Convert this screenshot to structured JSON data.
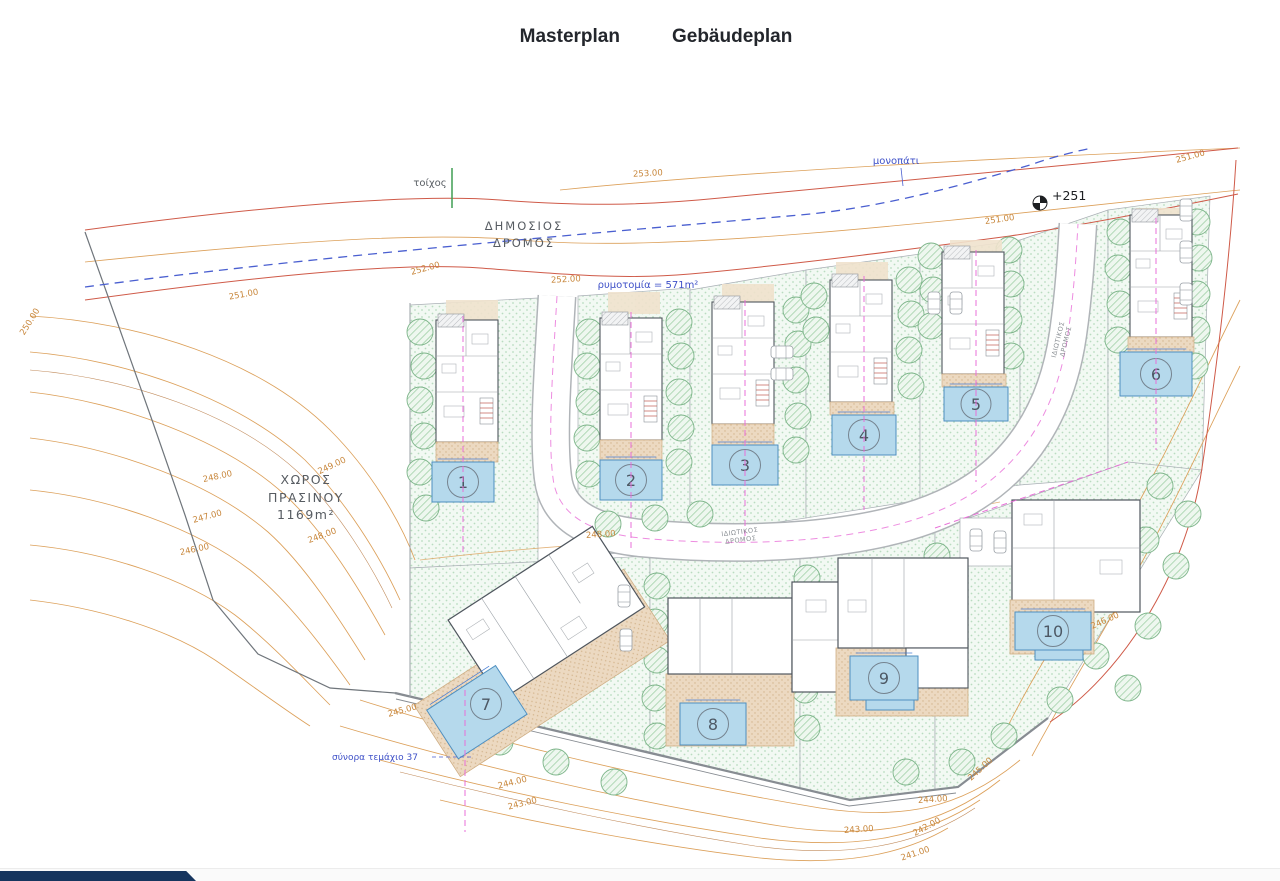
{
  "tabs": [
    {
      "label": "Masterplan",
      "active": true
    },
    {
      "label": "Gebäudeplan",
      "active": false
    }
  ],
  "plan": {
    "labels": {
      "wall": "τοίχος",
      "public_road_1": "ΔΗΜΟΣΙΟΣ",
      "public_road_2": "ΔΡΟΜΟΣ",
      "rymotomia": "ρυμοτομία = 571m²",
      "footpath": "μονοπάτι",
      "datum": "+251",
      "green_1": "ΧΩΡΟΣ",
      "green_2": "ΠΡΑΣΙΝΟΥ",
      "green_area": "1169m²",
      "private_road_l1": "ΙΔΙΩΤΙΚΟΣ",
      "private_road_l2": "ΔΡΟΜΟΣ",
      "boundary_note": "σύνορα τεμάχιο 37"
    },
    "plots": [
      {
        "number": "1"
      },
      {
        "number": "2"
      },
      {
        "number": "3"
      },
      {
        "number": "4"
      },
      {
        "number": "5"
      },
      {
        "number": "6"
      },
      {
        "number": "7"
      },
      {
        "number": "8"
      },
      {
        "number": "9"
      },
      {
        "number": "10"
      }
    ],
    "contours": [
      "253.00",
      "252.00",
      "252.00",
      "251.00",
      "251.00",
      "251.00",
      "250.00",
      "249.00",
      "248.00",
      "247.00",
      "246.00",
      "248.00",
      "248.00",
      "245.00",
      "244.00",
      "243.00",
      "245.00",
      "244.00",
      "243.00",
      "242.00",
      "241.00",
      "246.00"
    ]
  },
  "colors": {
    "accent_navy": "#16355e",
    "pool_fill": "#b5d9ec",
    "contour_orange": "#dca05a",
    "boundary_red": "#cf5a48",
    "dashed_blue": "#4a5fd0",
    "dashed_magenta": "#e86fd8",
    "tree_green": "#7cb489"
  }
}
